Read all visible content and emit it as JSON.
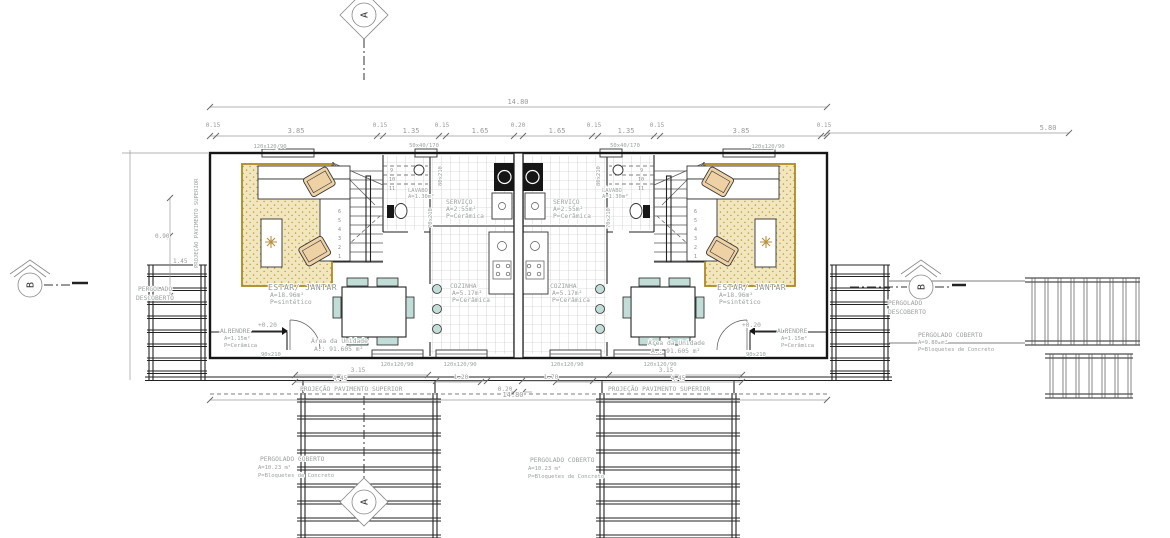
{
  "markers": {
    "a": "A",
    "b": "B"
  },
  "rooms": {
    "estar": {
      "name": "ESTAR/ JANTAR",
      "area": "A=18.96m²",
      "floor": "P=sintético"
    },
    "cozinha": {
      "name": "COZINHA",
      "area": "A=5.17m²",
      "floor": "P=Cerâmica"
    },
    "servico": {
      "name": "SERVIÇO",
      "area": "A=2.55m²",
      "floor": "P=Cerâmica"
    },
    "lavabo": {
      "name": "LAVABO",
      "area": "A=1.30m²",
      "floor": "P=Cerâmica"
    },
    "alpendre": {
      "name": "ALPENDRE",
      "area": "A=1.15m²",
      "floor": "P=Cerâmica"
    },
    "area_unidade": {
      "line1": "Área da Unidade",
      "line2": "A.: 91.605 m²"
    },
    "nivel": "+0.20"
  },
  "annotations": {
    "projecao": "PROJEÇÃO PAVIMENTO SUPERIOR",
    "perg_desc_1": "PERGOLADO",
    "perg_desc_2": "DESCOBERTO",
    "perg_cob": {
      "name": "PERGOLADO COBERTO",
      "area": "A=10.23 m²",
      "floor": "P=Bloquetes de Concreto"
    },
    "perg_cob_right": {
      "name": "PERGOLADO COBERTO",
      "area": "A=9.80 m²",
      "floor": "P=Bloquetes de Concreto"
    }
  },
  "openings": {
    "door90": "90x210",
    "door80": "80x210",
    "door70": "70x210",
    "win120": "120x120/90",
    "win50": "50x40/170"
  },
  "dims": {
    "total": "14.80",
    "right_total": "5.80",
    "top_row": [
      "0.15",
      "3.85",
      "0.15",
      "1.35",
      "0.15",
      "1.65",
      "0.20",
      "1.65",
      "0.15",
      "1.35",
      "0.15",
      "3.85",
      "0.15"
    ],
    "b_315": "3.15",
    "b_445": "4.45",
    "b_120": "1.20",
    "b_170": "1.70",
    "b_020": "0.20",
    "b_total": "14.80",
    "l_090": "0.90",
    "l_145": "1.45"
  },
  "stairs": [
    "1",
    "2",
    "3",
    "4",
    "5",
    "6",
    "9",
    "10",
    "11"
  ],
  "colors": {
    "rug": "#f1e6bd",
    "rug_dot": "#b9952f",
    "upholstery": "#eed2a6",
    "chairs": "#c2ddd8"
  }
}
